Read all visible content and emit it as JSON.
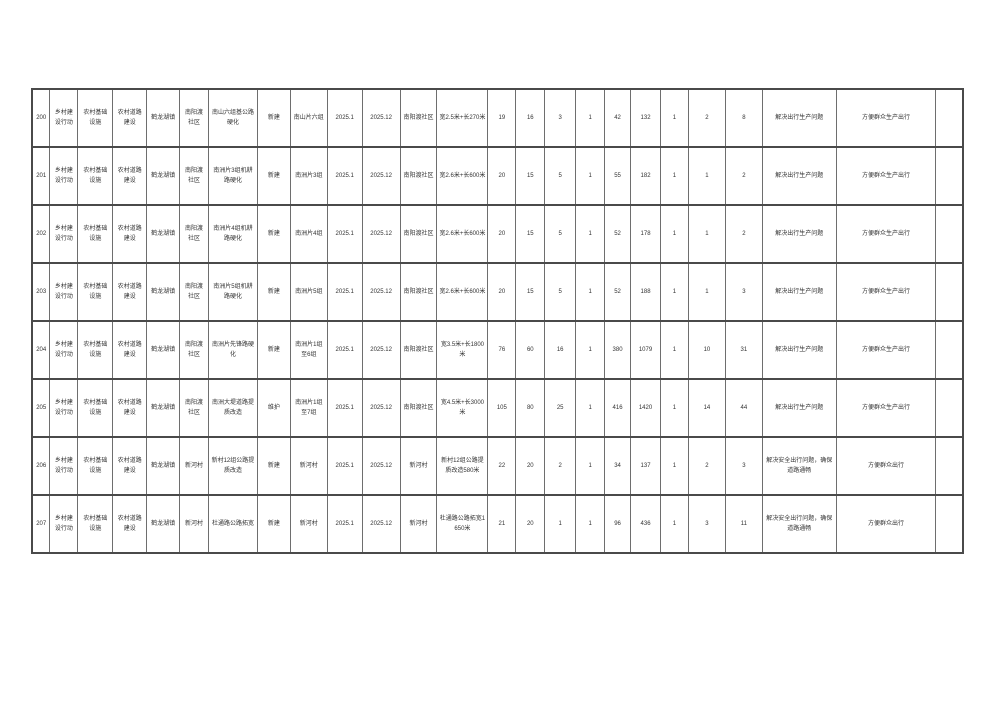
{
  "colors": {
    "page_bg": "#ffffff",
    "border_strong": "#4a4a4a",
    "border_light": "#6e6e6e",
    "text": "#333333"
  },
  "table": {
    "columns": [
      {
        "key": "seq",
        "width": 1.93
      },
      {
        "key": "action",
        "width": 3.0
      },
      {
        "key": "category",
        "width": 3.75
      },
      {
        "key": "subcategory",
        "width": 3.64
      },
      {
        "key": "town",
        "width": 3.54
      },
      {
        "key": "village",
        "width": 3.11
      },
      {
        "key": "project-name",
        "width": 5.25
      },
      {
        "key": "build-nature",
        "width": 3.54
      },
      {
        "key": "location",
        "width": 3.97
      },
      {
        "key": "start-date",
        "width": 3.75
      },
      {
        "key": "end-date",
        "width": 4.07
      },
      {
        "key": "implement-unit",
        "width": 3.97
      },
      {
        "key": "scale",
        "width": 5.47
      },
      {
        "key": "num1",
        "width": 3.0
      },
      {
        "key": "num2",
        "width": 3.11
      },
      {
        "key": "num3",
        "width": 3.32
      },
      {
        "key": "num4",
        "width": 3.11
      },
      {
        "key": "num5",
        "width": 2.79
      },
      {
        "key": "num6",
        "width": 3.22
      },
      {
        "key": "num7",
        "width": 3.0
      },
      {
        "key": "num8",
        "width": 3.97
      },
      {
        "key": "num9",
        "width": 3.97
      },
      {
        "key": "effect",
        "width": 7.93
      },
      {
        "key": "benefit",
        "width": 10.72
      },
      {
        "key": "blank",
        "width": 2.89
      }
    ],
    "rows": [
      [
        "200",
        "乡村建设行动",
        "农村基础设施",
        "农村道路建设",
        "鹤龙湖镇",
        "南阳渡社区",
        "南山六组基公路硬化",
        "新建",
        "南山片六组",
        "2025.1",
        "2025.12",
        "南阳渡社区",
        "宽2.5米+长270米",
        "19",
        "16",
        "3",
        "1",
        "42",
        "132",
        "1",
        "2",
        "8",
        "解决出行生产问题",
        "方便群众生产出行",
        ""
      ],
      [
        "201",
        "乡村建设行动",
        "农村基础设施",
        "农村道路建设",
        "鹤龙湖镇",
        "南阳渡社区",
        "南洲片3组机耕路硬化",
        "新建",
        "南洲片3组",
        "2025.1",
        "2025.12",
        "南阳渡社区",
        "宽2.6米+长600米",
        "20",
        "15",
        "5",
        "1",
        "55",
        "182",
        "1",
        "1",
        "2",
        "解决出行生产问题",
        "方便群众生产出行",
        ""
      ],
      [
        "202",
        "乡村建设行动",
        "农村基础设施",
        "农村道路建设",
        "鹤龙湖镇",
        "南阳渡社区",
        "南洲片4组机耕路硬化",
        "新建",
        "南洲片4组",
        "2025.1",
        "2025.12",
        "南阳渡社区",
        "宽2.6米+长600米",
        "20",
        "15",
        "5",
        "1",
        "52",
        "178",
        "1",
        "1",
        "2",
        "解决出行生产问题",
        "方便群众生产出行",
        ""
      ],
      [
        "203",
        "乡村建设行动",
        "农村基础设施",
        "农村道路建设",
        "鹤龙湖镇",
        "南阳渡社区",
        "南洲片5组机耕路硬化",
        "新建",
        "南洲片5组",
        "2025.1",
        "2025.12",
        "南阳渡社区",
        "宽2.6米+长600米",
        "20",
        "15",
        "5",
        "1",
        "52",
        "188",
        "1",
        "1",
        "3",
        "解决出行生产问题",
        "方便群众生产出行",
        ""
      ],
      [
        "204",
        "乡村建设行动",
        "农村基础设施",
        "农村道路建设",
        "鹤龙湖镇",
        "南阳渡社区",
        "南洲片先锋路硬化",
        "新建",
        "南洲片1组至6组",
        "2025.1",
        "2025.12",
        "南阳渡社区",
        "宽3.5米+长1800米",
        "76",
        "60",
        "16",
        "1",
        "380",
        "1079",
        "1",
        "10",
        "31",
        "解决出行生产问题",
        "方便群众生产出行",
        ""
      ],
      [
        "205",
        "乡村建设行动",
        "农村基础设施",
        "农村道路建设",
        "鹤龙湖镇",
        "南阳渡社区",
        "南洲大堤道路提质改造",
        "维护",
        "南洲片1组至7组",
        "2025.1",
        "2025.12",
        "南阳渡社区",
        "宽4.5米+长3000米",
        "105",
        "80",
        "25",
        "1",
        "416",
        "1420",
        "1",
        "14",
        "44",
        "解决出行生产问题",
        "方便群众生产出行",
        ""
      ],
      [
        "206",
        "乡村建设行动",
        "农村基础设施",
        "农村道路建设",
        "鹤龙湖镇",
        "新河村",
        "新村12组公路提质改造",
        "新建",
        "新河村",
        "2025.1",
        "2025.12",
        "新河村",
        "新村12组公路提质改造580米",
        "22",
        "20",
        "2",
        "1",
        "34",
        "137",
        "1",
        "2",
        "3",
        "解决安全出行问题，确保道路通畅",
        "方便群众出行",
        ""
      ],
      [
        "207",
        "乡村建设行动",
        "农村基础设施",
        "农村道路建设",
        "鹤龙湖镇",
        "新河村",
        "杜通路公路拓宽",
        "新建",
        "新河村",
        "2025.1",
        "2025.12",
        "新河村",
        "杜通路公路拓宽1650米",
        "21",
        "20",
        "1",
        "1",
        "96",
        "436",
        "1",
        "3",
        "11",
        "解决安全出行问题，确保道路通畅",
        "方便群众出行",
        ""
      ]
    ]
  }
}
